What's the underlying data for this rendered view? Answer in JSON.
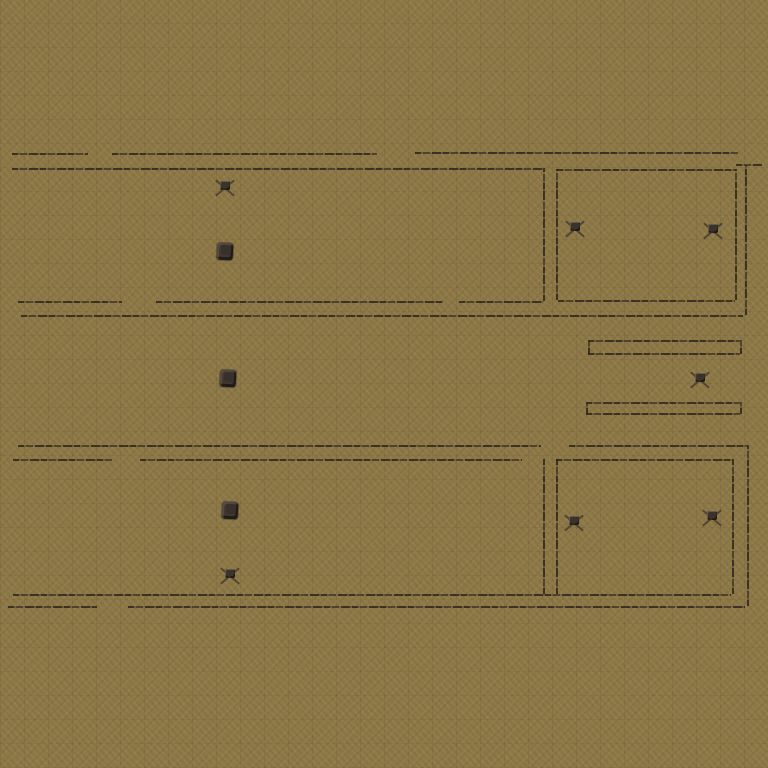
{
  "scene": {
    "description": "top-down game map: hand-drawn floor plan walls on khaki dirt ground",
    "background_color": "#8c7745",
    "tile_size_px": 24,
    "wall_color": "#3a322a",
    "sprite_dark_color": "#362e26",
    "sprite_light_color": "#6e6459",
    "viewport": {
      "width": 768,
      "height": 768
    }
  },
  "walls": [
    {
      "id": "room1-top-outer-a",
      "dir": "h",
      "x": 12,
      "y": 153,
      "len": 76
    },
    {
      "id": "room1-top-outer-b",
      "dir": "h",
      "x": 112,
      "y": 153,
      "len": 265
    },
    {
      "id": "room1-top-outer-c",
      "dir": "h",
      "x": 415,
      "y": 152,
      "len": 323
    },
    {
      "id": "room1-top-inner",
      "dir": "h",
      "x": 12,
      "y": 168,
      "len": 531
    },
    {
      "id": "room2-top",
      "dir": "h",
      "x": 557,
      "y": 169,
      "len": 179
    },
    {
      "id": "room2-topright-stub",
      "dir": "h",
      "x": 736,
      "y": 164,
      "len": 26
    },
    {
      "id": "room1-bottom-inner-a",
      "dir": "h",
      "x": 18,
      "y": 301,
      "len": 104
    },
    {
      "id": "room1-bottom-inner-b",
      "dir": "h",
      "x": 156,
      "y": 301,
      "len": 287
    },
    {
      "id": "room1-bottom-inner-c",
      "dir": "h",
      "x": 459,
      "y": 301,
      "len": 84
    },
    {
      "id": "room2-bottom",
      "dir": "h",
      "x": 558,
      "y": 300,
      "len": 177
    },
    {
      "id": "row1-bottom-outer",
      "dir": "h",
      "x": 21,
      "y": 315,
      "len": 722
    },
    {
      "id": "capsule1-top",
      "dir": "h",
      "x": 588,
      "y": 340,
      "len": 152
    },
    {
      "id": "capsule1-bottom",
      "dir": "h",
      "x": 588,
      "y": 353,
      "len": 152
    },
    {
      "id": "capsule2-top",
      "dir": "h",
      "x": 586,
      "y": 402,
      "len": 154
    },
    {
      "id": "capsule2-bottom",
      "dir": "h",
      "x": 586,
      "y": 413,
      "len": 154
    },
    {
      "id": "room3-top-outer-a",
      "dir": "h",
      "x": 18,
      "y": 445,
      "len": 523
    },
    {
      "id": "room3-top-outer-b",
      "dir": "h",
      "x": 569,
      "y": 445,
      "len": 178
    },
    {
      "id": "room3-top-inner-a",
      "dir": "h",
      "x": 13,
      "y": 459,
      "len": 99
    },
    {
      "id": "room3-top-inner-b",
      "dir": "h",
      "x": 140,
      "y": 459,
      "len": 382
    },
    {
      "id": "room4-top",
      "dir": "h",
      "x": 556,
      "y": 459,
      "len": 176
    },
    {
      "id": "row2-bottom-inner",
      "dir": "h",
      "x": 13,
      "y": 594,
      "len": 718
    },
    {
      "id": "row2-bottom-outer-a",
      "dir": "h",
      "x": 8,
      "y": 606,
      "len": 89
    },
    {
      "id": "row2-bottom-outer-b",
      "dir": "h",
      "x": 128,
      "y": 606,
      "len": 617
    },
    {
      "id": "room1-right-wall",
      "dir": "v",
      "x": 543,
      "y": 168,
      "len": 133
    },
    {
      "id": "room2-left-wall",
      "dir": "v",
      "x": 556,
      "y": 169,
      "len": 131
    },
    {
      "id": "room2-right-wall",
      "dir": "v",
      "x": 735,
      "y": 169,
      "len": 131
    },
    {
      "id": "outer-right-top",
      "dir": "v",
      "x": 745,
      "y": 165,
      "len": 150
    },
    {
      "id": "capsule1-left-cap",
      "dir": "v",
      "x": 588,
      "y": 340,
      "len": 14
    },
    {
      "id": "capsule1-right-cap",
      "dir": "v",
      "x": 740,
      "y": 340,
      "len": 14
    },
    {
      "id": "capsule2-left-cap",
      "dir": "v",
      "x": 586,
      "y": 402,
      "len": 12
    },
    {
      "id": "capsule2-right-cap",
      "dir": "v",
      "x": 740,
      "y": 402,
      "len": 12
    },
    {
      "id": "room3-right-wall",
      "dir": "v",
      "x": 543,
      "y": 459,
      "len": 135
    },
    {
      "id": "room4-left-wall",
      "dir": "v",
      "x": 556,
      "y": 459,
      "len": 135
    },
    {
      "id": "room4-right-wall",
      "dir": "v",
      "x": 732,
      "y": 459,
      "len": 135
    },
    {
      "id": "outer-right-bottom",
      "dir": "v",
      "x": 747,
      "y": 445,
      "len": 161
    }
  ],
  "sprites": [
    {
      "type": "cross",
      "x": 225,
      "y": 188
    },
    {
      "type": "blob",
      "x": 225,
      "y": 251
    },
    {
      "type": "cross",
      "x": 575,
      "y": 229
    },
    {
      "type": "cross",
      "x": 713,
      "y": 231
    },
    {
      "type": "blob",
      "x": 228,
      "y": 378
    },
    {
      "type": "cross",
      "x": 700,
      "y": 380
    },
    {
      "type": "blob",
      "x": 230,
      "y": 510
    },
    {
      "type": "cross",
      "x": 230,
      "y": 576
    },
    {
      "type": "cross",
      "x": 574,
      "y": 523
    },
    {
      "type": "cross",
      "x": 712,
      "y": 518
    }
  ]
}
